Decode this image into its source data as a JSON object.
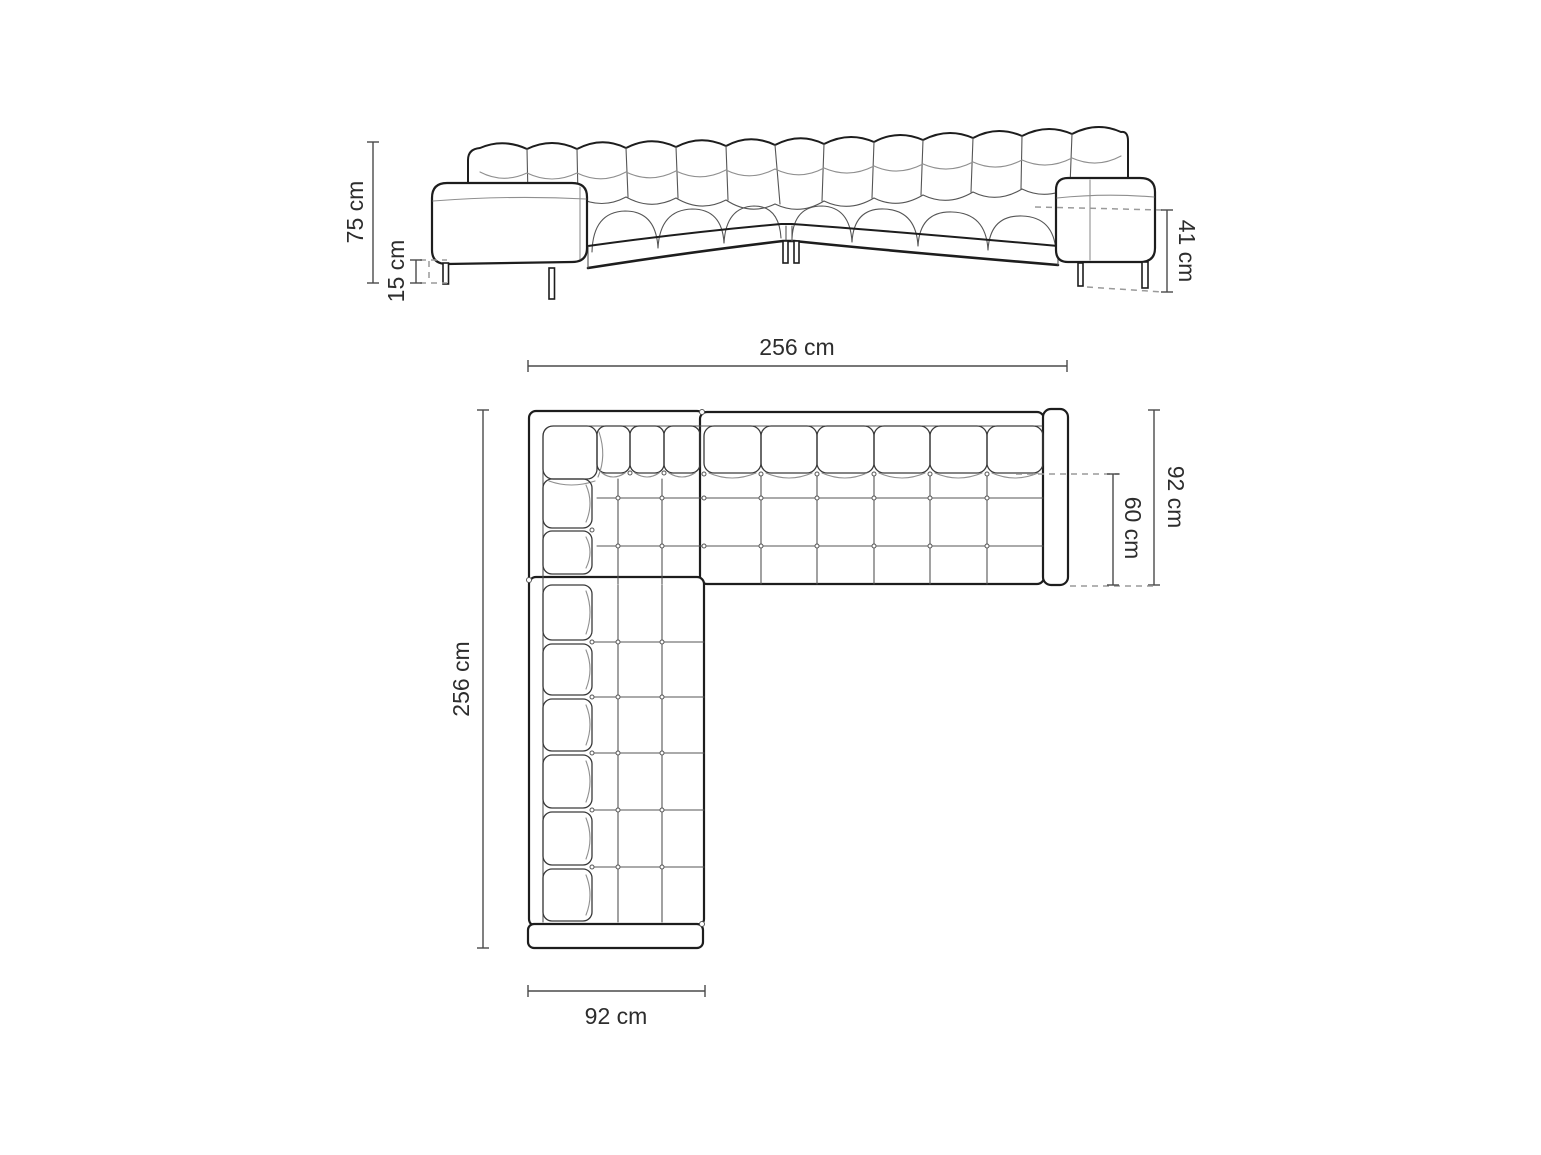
{
  "front_view": {
    "overall_height": "75 cm",
    "leg_height": "15 cm",
    "seat_height": "41 cm"
  },
  "top_view": {
    "total_width": "256 cm",
    "total_depth": "256 cm",
    "side_depth": "92 cm",
    "seat_depth": "60 cm",
    "chaise_width": "92 cm"
  },
  "units": "cm",
  "colors": {
    "background": "#ffffff",
    "sofa_line": "#1d1d1d",
    "detail_line": "#555555",
    "soft_line": "#8f8f8f",
    "dimension_line": "#4a4a4a",
    "dashed_line": "#9a9a9a",
    "text": "#2d2d2d"
  }
}
